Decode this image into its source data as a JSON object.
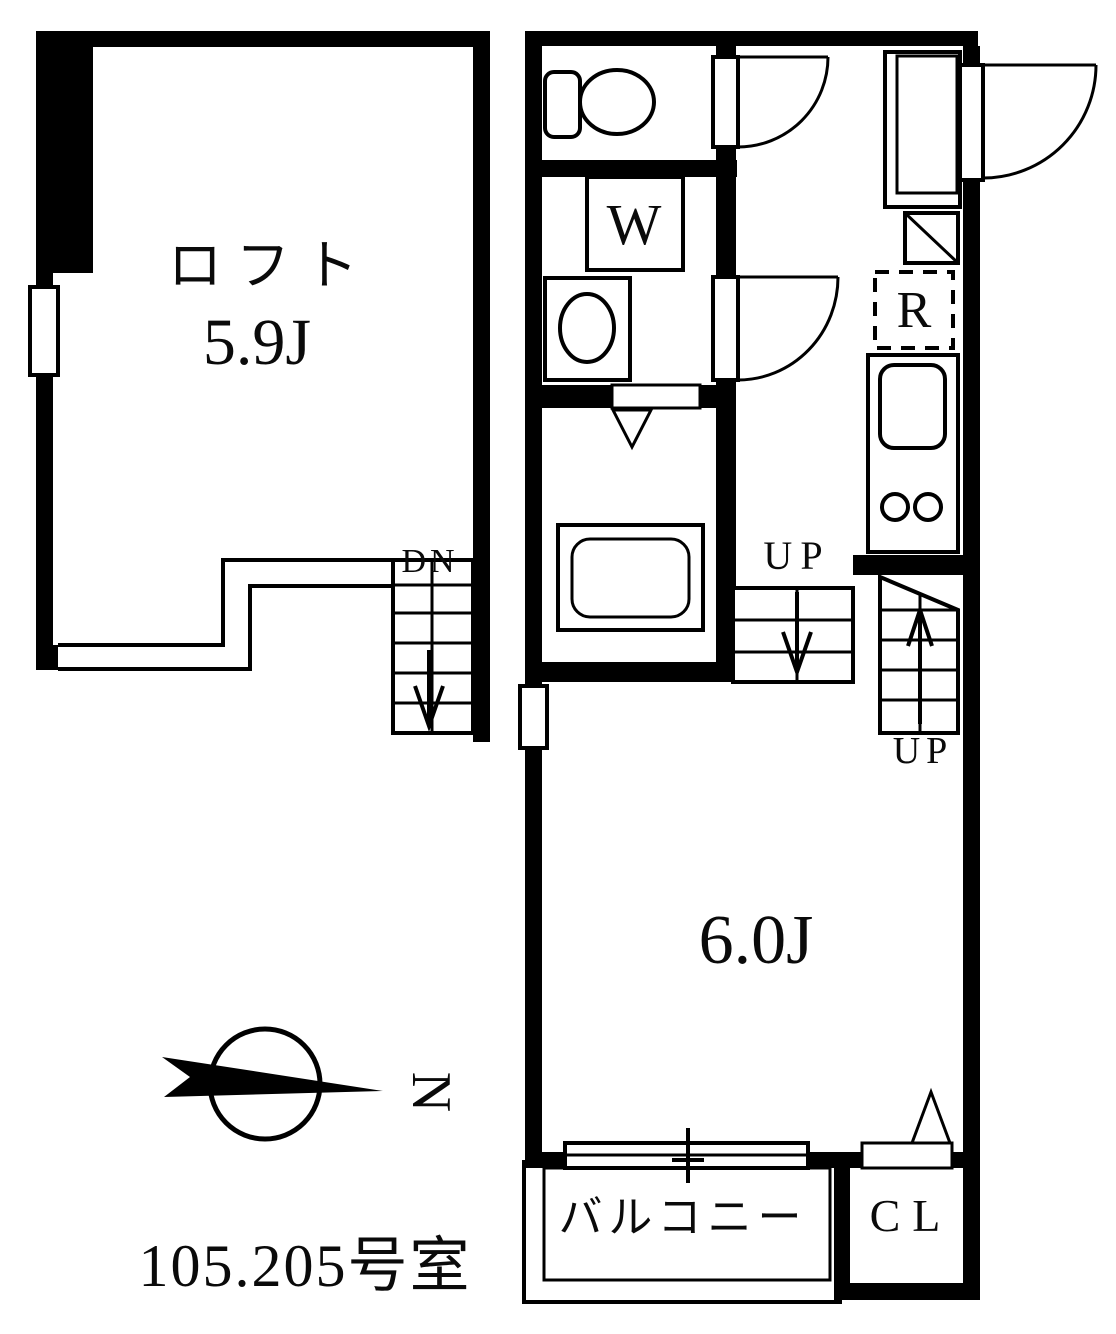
{
  "title": {
    "unit_number": "105.205号室"
  },
  "compass": {
    "north_label": "N"
  },
  "loft_unit": {
    "room_label": "ロフト",
    "size_label": "5.9J",
    "stairs_label": "DN"
  },
  "main_unit": {
    "size_label": "6.0J",
    "stairs_lower_label": "UP",
    "stairs_upper_label": "UP",
    "washing_machine_label": "W",
    "refrigerator_label": "R",
    "balcony_label": "バルコニー",
    "closet_label": "CL"
  },
  "colors": {
    "line": "#000000",
    "background": "#ffffff"
  }
}
